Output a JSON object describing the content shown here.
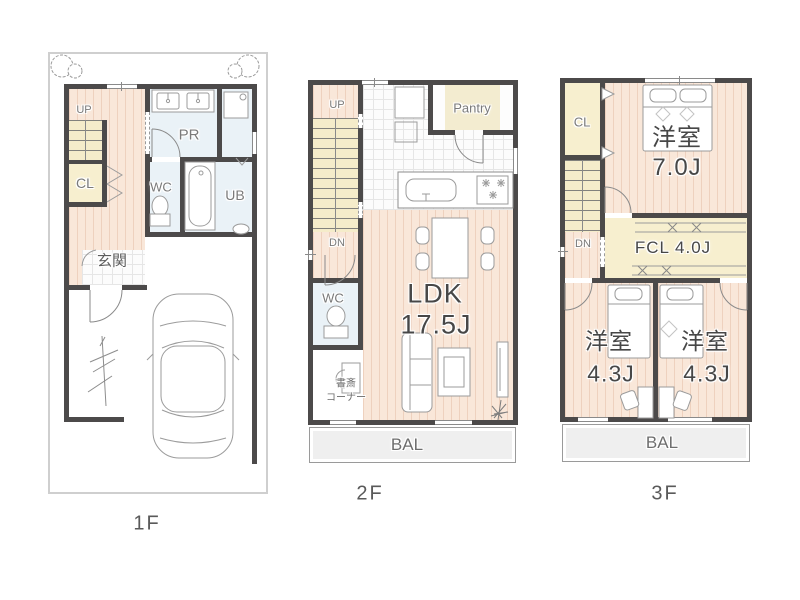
{
  "palette": {
    "wall": "#4c4a4a",
    "wood_floor": "#f9e7d9",
    "closet_floor": "#f7efcf",
    "wet_area_floor": "#eaf2f7",
    "balcony": "#efefef"
  },
  "floor1": {
    "label": "1F",
    "rooms": {
      "up": "UP",
      "cl": "CL",
      "pr": "PR",
      "wc": "WC",
      "ub": "UB",
      "genkan": "玄関"
    }
  },
  "floor2": {
    "label": "2F",
    "rooms": {
      "up": "UP",
      "dn": "DN",
      "pantry": "Pantry",
      "wc": "WC",
      "ldk_name": "LDK",
      "ldk_size": "17.5J",
      "study_line1": "書斎",
      "study_line2": "コーナー",
      "bal": "BAL"
    }
  },
  "floor3": {
    "label": "3F",
    "rooms": {
      "cl": "CL",
      "dn": "DN",
      "main_name": "洋室",
      "main_size": "7.0J",
      "fcl": "FCL 4.0J",
      "room_a_name": "洋室",
      "room_a_size": "4.3J",
      "room_b_name": "洋室",
      "room_b_size": "4.3J",
      "bal": "BAL"
    }
  }
}
